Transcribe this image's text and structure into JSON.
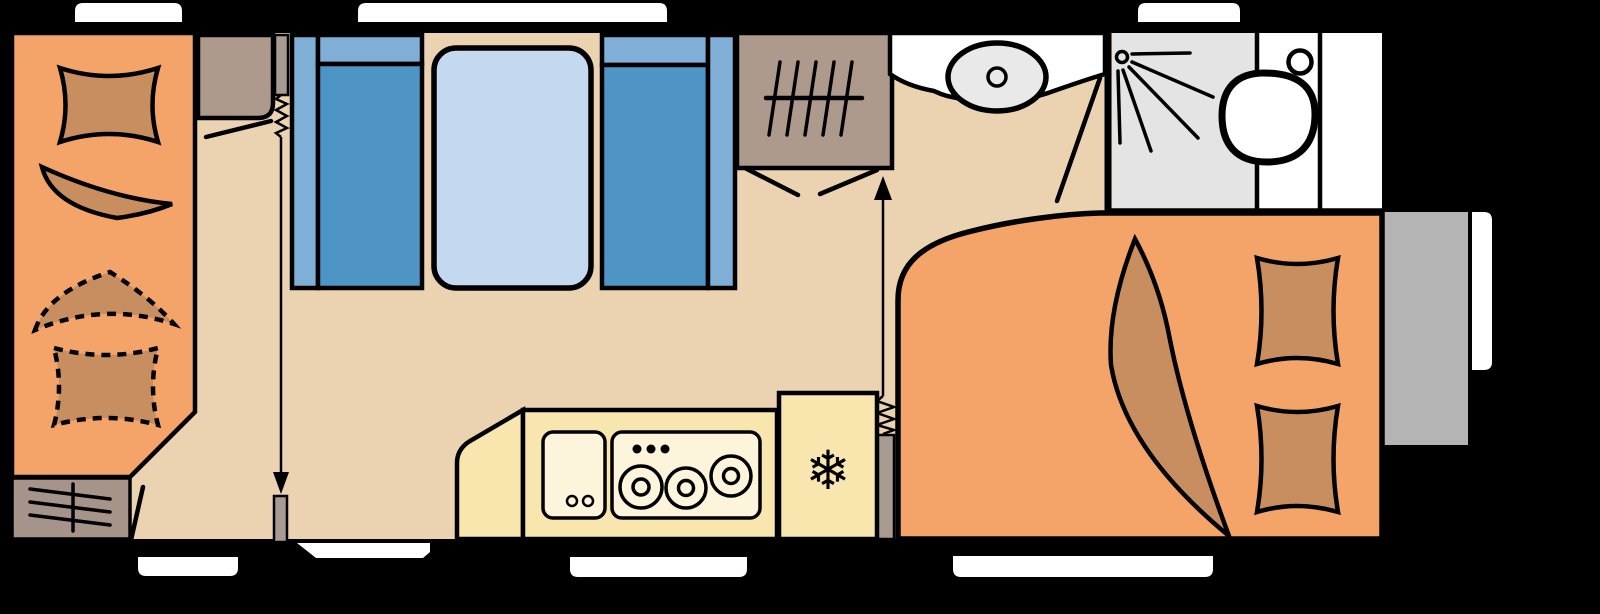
{
  "image": {
    "width": 1600,
    "height": 614,
    "kind": "caravan-floor-plan"
  },
  "colors": {
    "background": "#000000",
    "black": "#000000",
    "white": "#FFFFFF",
    "floor": "#EBD3B2",
    "bed_orange": "#F4A469",
    "cushion_brown": "#C98E5F",
    "seat_blue": "#4E95C5",
    "backrest_blue": "#7FAFD6",
    "table_blue": "#C4D8EF",
    "cabinet_brown": "#AE9A8C",
    "heater_gray": "#A6948B",
    "kitchen_yellow": "#F9E6AE",
    "appliance_cream": "#FDF5DB",
    "shower_gray": "#E4E4E4",
    "sink_gray": "#E9E9E9",
    "exterior_gray": "#B4B4B4",
    "slider_gray": "#A89B92"
  },
  "icons": {
    "snowflake": "❄",
    "shower_head": "spray-rays-icon",
    "hob": "three-burner-rings",
    "heater": "slatted-grille",
    "wardrobe": "hanging-rail-ticks",
    "partition": "spring-and-arrow"
  },
  "areas": {
    "front_bedroom": "french-bed-with-optional-extension",
    "dinette": "two-facing-benches-with-table",
    "kitchen": "sink-hob-and-fridge",
    "washroom": "basin-shower-toilet",
    "rear_bedroom": "double-bed"
  },
  "window_count": 7
}
